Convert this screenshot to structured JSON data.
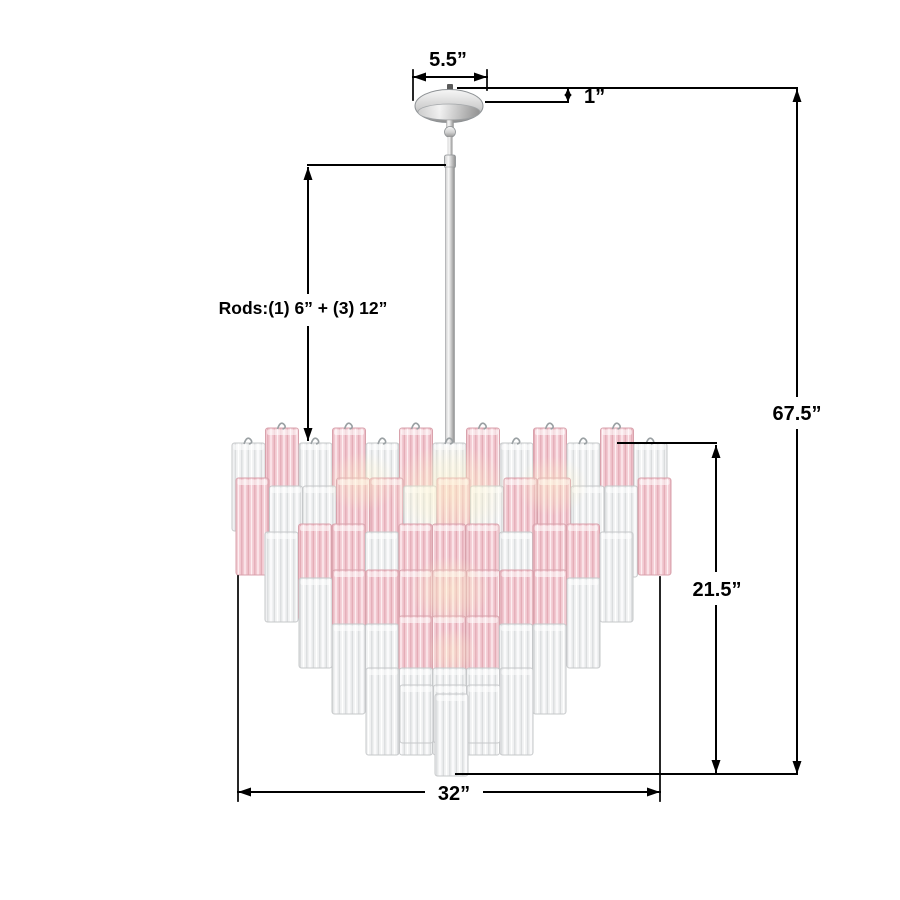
{
  "page": {
    "background": "#ffffff"
  },
  "dimensions": {
    "canopy_width": "5.5”",
    "canopy_height": "1”",
    "overall_height": "67.5”",
    "fixture_height": "21.5”",
    "fixture_width": "32”",
    "rods_note": "Rods:(1) 6” + (3) 12”"
  },
  "figure": {
    "subject": "two-tone pink and clear tronchi glass tube chandelier with polished chrome canopy and downrod",
    "colors": {
      "pink_base": "#f2c9d1",
      "pink_ridge": "#e2a9b4",
      "pink_light": "#fdeef1",
      "pink_stroke": "#d8a2ac",
      "clear_base": "#f0f1f2",
      "clear_ridge": "#d8dadb",
      "clear_light": "#ffffff",
      "clear_stroke": "#c6c8ca",
      "chrome_light": "#f7f7f7",
      "chrome_mid": "#cfcfcf",
      "chrome_dark": "#8e8e8e",
      "glow": "#fff3c9",
      "line": "#000000"
    },
    "tube_width": 33,
    "tube_step": 33.5,
    "tiers": [
      {
        "x": 232,
        "y": 428,
        "len": 100,
        "pattern": "CPCPCPCPCPCPC",
        "drop": 15,
        "dropLen": -12
      },
      {
        "x": 236,
        "y": 478,
        "len": 97,
        "pattern": "PCCPPCPCPPCCP",
        "drop": 8,
        "dropLen": -6
      },
      {
        "x": 265,
        "y": 524,
        "len": 96,
        "pattern": "CPPCPPPCPPC",
        "drop": 8,
        "dropLen": -6
      },
      {
        "x": 299,
        "y": 570,
        "len": 96,
        "pattern": "CPPPPPPPC",
        "drop": 8,
        "dropLen": -6
      },
      {
        "x": 332,
        "y": 616,
        "len": 96,
        "pattern": "CCPPPCC",
        "drop": 8,
        "dropLen": -6
      },
      {
        "x": 366,
        "y": 662,
        "len": 92,
        "pattern": "CCCCC",
        "drop": 6,
        "dropLen": -5
      },
      {
        "x": 400,
        "y": 680,
        "len": 62,
        "pattern": "CCC",
        "drop": 5,
        "dropLen": -4
      },
      {
        "x": 435,
        "y": 694,
        "len": 82,
        "pattern": "C",
        "drop": 0,
        "dropLen": 0
      }
    ],
    "glows_back": [
      {
        "x": 450,
        "y": 492,
        "rx": 60,
        "ry": 48,
        "o": 0.6
      },
      {
        "x": 362,
        "y": 482,
        "rx": 36,
        "ry": 30,
        "o": 0.45
      },
      {
        "x": 552,
        "y": 486,
        "rx": 36,
        "ry": 30,
        "o": 0.45
      }
    ],
    "glows_front": [
      {
        "x": 450,
        "y": 590,
        "rx": 40,
        "ry": 34,
        "o": 0.5
      },
      {
        "x": 452,
        "y": 652,
        "rx": 26,
        "ry": 24,
        "o": 0.4
      }
    ]
  }
}
